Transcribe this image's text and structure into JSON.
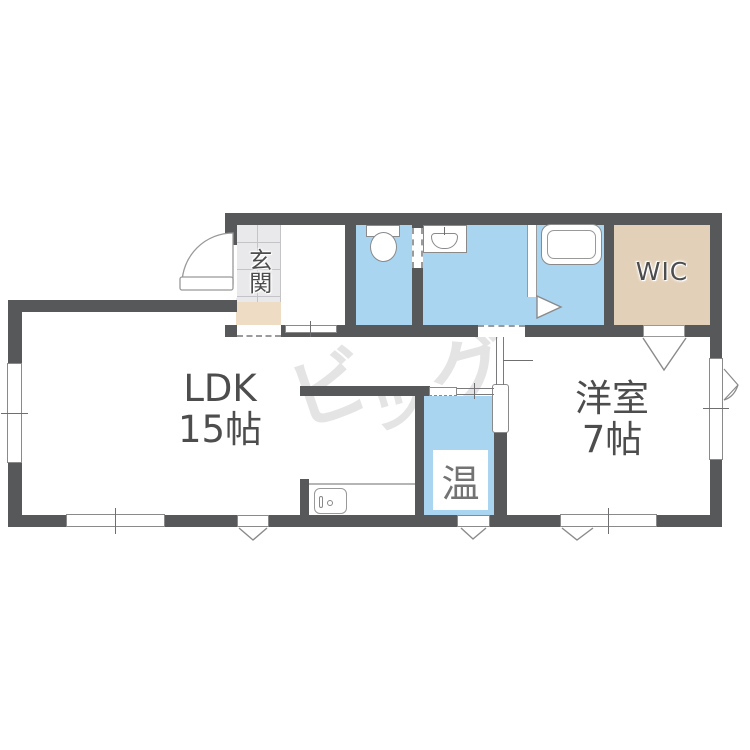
{
  "plan": {
    "watermark": {
      "full": "ビッグ",
      "c1": "ビ",
      "c2": "ッ",
      "c3": "グ"
    },
    "rooms": {
      "ldk": {
        "name": "LDK",
        "size": "15帖"
      },
      "western": {
        "name": "洋室",
        "size": "7帖"
      },
      "wic": {
        "label": "WIC"
      },
      "entrance": {
        "label": "玄関"
      },
      "heater": {
        "label": "温"
      }
    },
    "colors": {
      "wall": "#57585a",
      "wet_area_blue": "#a9d5f1",
      "closet_beige": "#e3d0b8",
      "step_beige": "#eedcc5",
      "tile_gray": "#e9e9eb",
      "label_text": "#4d4d4d",
      "watermark_gray": "#e4e4e4"
    }
  }
}
